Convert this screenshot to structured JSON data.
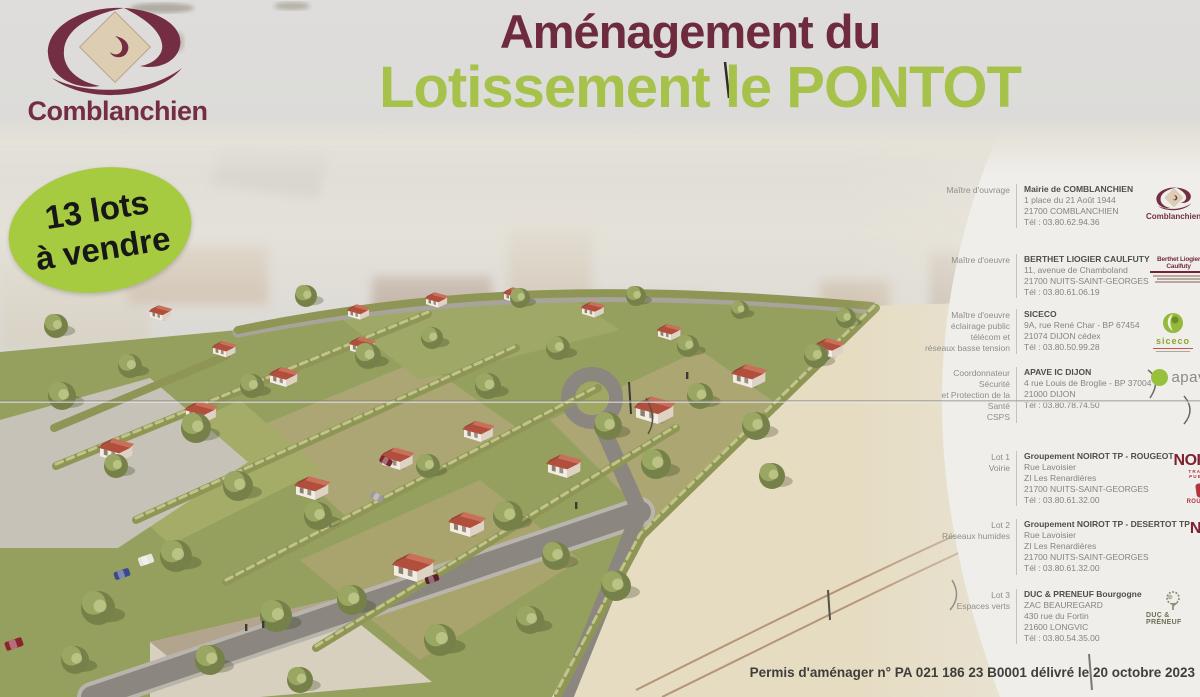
{
  "sign": {
    "title_line1": "Aménagement du",
    "title_line2": "Lotissement le PONTOT",
    "brand": "Comblanchien",
    "badge_line1": "13 lots",
    "badge_line2": "à vendre",
    "permit": "Permis d'aménager n° PA 021 186 23 B0001 délivré le 20 octobre 2023"
  },
  "colors": {
    "title_maroon": "#6d2b3d",
    "title_green": "#a6c24b",
    "badge_green": "#a6cb40",
    "noirot_red": "#7d2130",
    "rougeot_red": "#b5333f",
    "siceco_green": "#8aa52e",
    "apave_green": "#97c13d",
    "roof_red": "#b24f3c"
  },
  "directory": {
    "sections": [
      {
        "label_lines": [
          "Maître d'ouvrage"
        ],
        "name": "Mairie de COMBLANCHIEN",
        "address_lines": [
          "1 place du 21 Août 1944",
          "21700 COMBLANCHIEN"
        ],
        "tel": "Tél : 03.80.62.94.36",
        "logos": [
          {
            "type": "comblanchien",
            "text": "Comblanchien"
          }
        ]
      },
      {
        "label_lines": [
          "Maître d'oeuvre"
        ],
        "name": "BERTHET LIOGIER CAULFUTY",
        "address_lines": [
          "11, avenue de Chamboland",
          "21700 NUITS-SAINT-GEORGES"
        ],
        "tel": "Tél : 03.80.61.06.19",
        "logos": [
          {
            "type": "berthet",
            "text": "Berthet Liogier Caulfuty"
          }
        ]
      },
      {
        "label_lines": [
          "Maître d'oeuvre",
          "éclairage public",
          "télécom et",
          "réseaux basse tension"
        ],
        "name": "SICECO",
        "address_lines": [
          "9A, rue René Char - BP 67454",
          "21074 DIJON cédex"
        ],
        "tel": "Tél : 03.80.50.99.28",
        "logos": [
          {
            "type": "siceco",
            "text": "siceco"
          }
        ]
      },
      {
        "label_lines": [
          "Coordonnateur Sécurité",
          "et Protection de la Santé",
          "CSPS"
        ],
        "name": "APAVE IC DIJON",
        "address_lines": [
          "4 rue Louis de Broglie - BP 37004",
          "21000 DIJON"
        ],
        "tel": "Tél : 03.80.78.74.50",
        "logos": [
          {
            "type": "apave",
            "text": "apave"
          }
        ]
      },
      {
        "label_lines": [
          "Lot 1",
          "Voirie"
        ],
        "name": "Groupement NOIROT TP - ROUGEOT",
        "address_lines": [
          "Rue Lavoisier",
          "ZI Les Renardières",
          "21700 NUITS-SAINT-GEORGES"
        ],
        "tel": "Tél : 03.80.61.32.00",
        "logos": [
          {
            "type": "noirot",
            "text": "NOIROT",
            "sub": "TRAVAUX PUBLICS"
          },
          {
            "type": "rougeot",
            "text": "ROUGEOT"
          }
        ]
      },
      {
        "label_lines": [
          "Lot 2",
          "Réseaux humides"
        ],
        "name": "Groupement NOIROT TP - DESERTOT TP",
        "address_lines": [
          "Rue Lavoisier",
          "ZI Les Renardières",
          "21700 NUITS-SAINT-GEORGES"
        ],
        "tel": "Tél : 03.80.61.32.00",
        "logos": [
          {
            "type": "noirot",
            "text": "NOIROT",
            "sub": "TRAVAUX PUBLICS"
          },
          {
            "type": "desertot",
            "text": "DESERTOT"
          }
        ]
      },
      {
        "label_lines": [
          "Lot 3",
          "Espaces verts"
        ],
        "name": "DUC & PRENEUF Bourgogne",
        "address_lines": [
          "ZAC BEAUREGARD",
          "430 rue du Fortin",
          "21600 LONGVIC"
        ],
        "tel": "Tél : 03.80.54.35.00",
        "logos": [
          {
            "type": "ducpreneuf",
            "text": "DUC & PRÉNEUF"
          }
        ]
      }
    ]
  }
}
